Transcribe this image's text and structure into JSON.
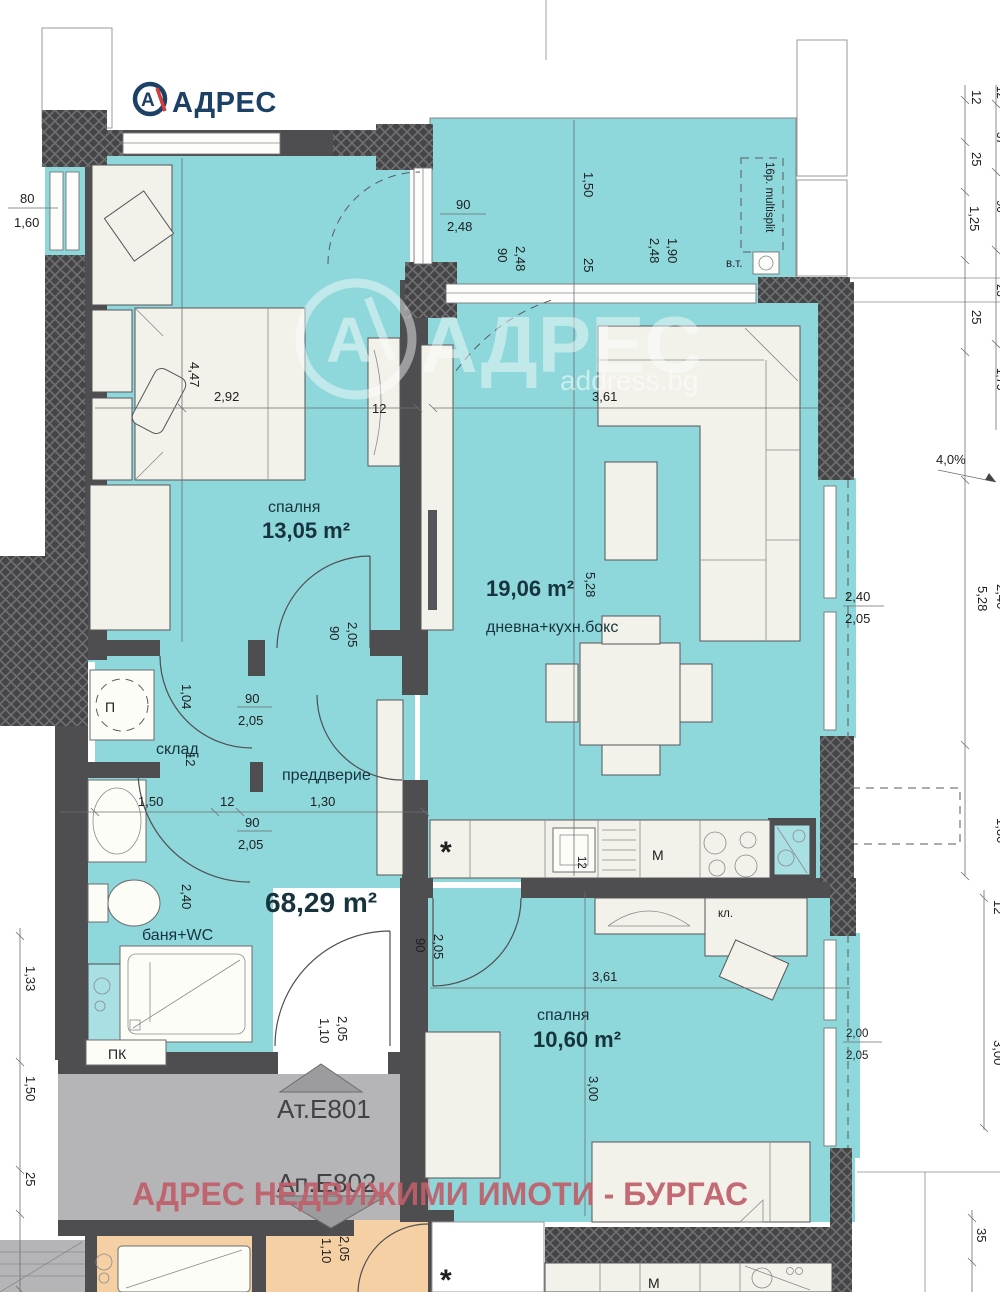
{
  "logo": {
    "brand": "АДРЕС",
    "mark": "А"
  },
  "watermark": {
    "mark": "А",
    "brand": "АДРЕС",
    "site": "address.bg"
  },
  "agency_banner": "АДРЕС НЕДВИЖИМИ ИМОТИ - БУРГАС",
  "plan": {
    "total_area": "68,29 m²",
    "units": {
      "top": "Ат.Е801",
      "bottom": "Ап.Е802"
    },
    "rooms": {
      "bedroom1": {
        "name": "спалня",
        "area": "13,05 m²",
        "width": "2,92",
        "depth": "4,47"
      },
      "living": {
        "name": "дневна+кухн.бокс",
        "area": "19,06 m²",
        "width": "3,61",
        "depth": "5,28"
      },
      "storage": {
        "name": "склад",
        "depth": "1,04"
      },
      "hall": {
        "name": "преддверие",
        "width": "1,30"
      },
      "bath": {
        "name": "баня+WC",
        "depth": "2,40"
      },
      "bedroom2": {
        "name": "спалня",
        "area": "10,60 m²",
        "width": "3,61",
        "depth": "3,00"
      }
    },
    "fixtures": {
      "washer": "П",
      "kitchen_m": "M",
      "kitchen_m2": "M",
      "closet": "кл.",
      "pk": "ПК",
      "vt": "в.т.",
      "multisplit": "16р. multisplit",
      "star": "*",
      "star2": "*"
    },
    "dims": {
      "left_win_w": "80",
      "left_win_h": "1,60",
      "bed1_win_w": "90",
      "bed1_win_h": "2,48",
      "ter_door_w": "90",
      "ter_door_h": "2,48",
      "ter_len": "1,50",
      "ter_25": "25",
      "ter_win_w": "1,90",
      "ter_win_h": "2,48",
      "wr_12": "12",
      "st_door_w": "90",
      "st_door_h": "2,05",
      "hall_door_w": "90",
      "hall_door_h": "2,05",
      "bath_door_w": "90",
      "bath_door_h": "2,05",
      "bed2_door_w": "90",
      "bed2_door_h": "2,05",
      "hall_150": "1,50",
      "hall_12": "12",
      "hall_130": "1,30",
      "st_104": "1,04",
      "st_12": "12",
      "bath_240": "2,40",
      "entry_w": "1,10",
      "entry_h": "2,05",
      "apt2_door_w": "1,10",
      "apt2_door_h": "2,05",
      "counter_12": "12",
      "ter2_w": "2,40",
      "ter2_h": "2,05",
      "r_12": "12",
      "r_25a": "25",
      "r_125": "1,25",
      "r_25b": "25",
      "rr_12": "12",
      "rr_37": "37",
      "rr_90": "90",
      "rr_23": "23",
      "rr_175": "1,75",
      "slope": "4,0%",
      "r_528": "5,28",
      "r_240": "2,40",
      "r_180": "1,80",
      "l_133": "1,33",
      "l_150": "1,50",
      "l_25": "25",
      "b2_200": "2,00",
      "b2_205": "2,05",
      "b2_12": "12",
      "b2_300": "3,00",
      "b2_35": "35"
    }
  }
}
